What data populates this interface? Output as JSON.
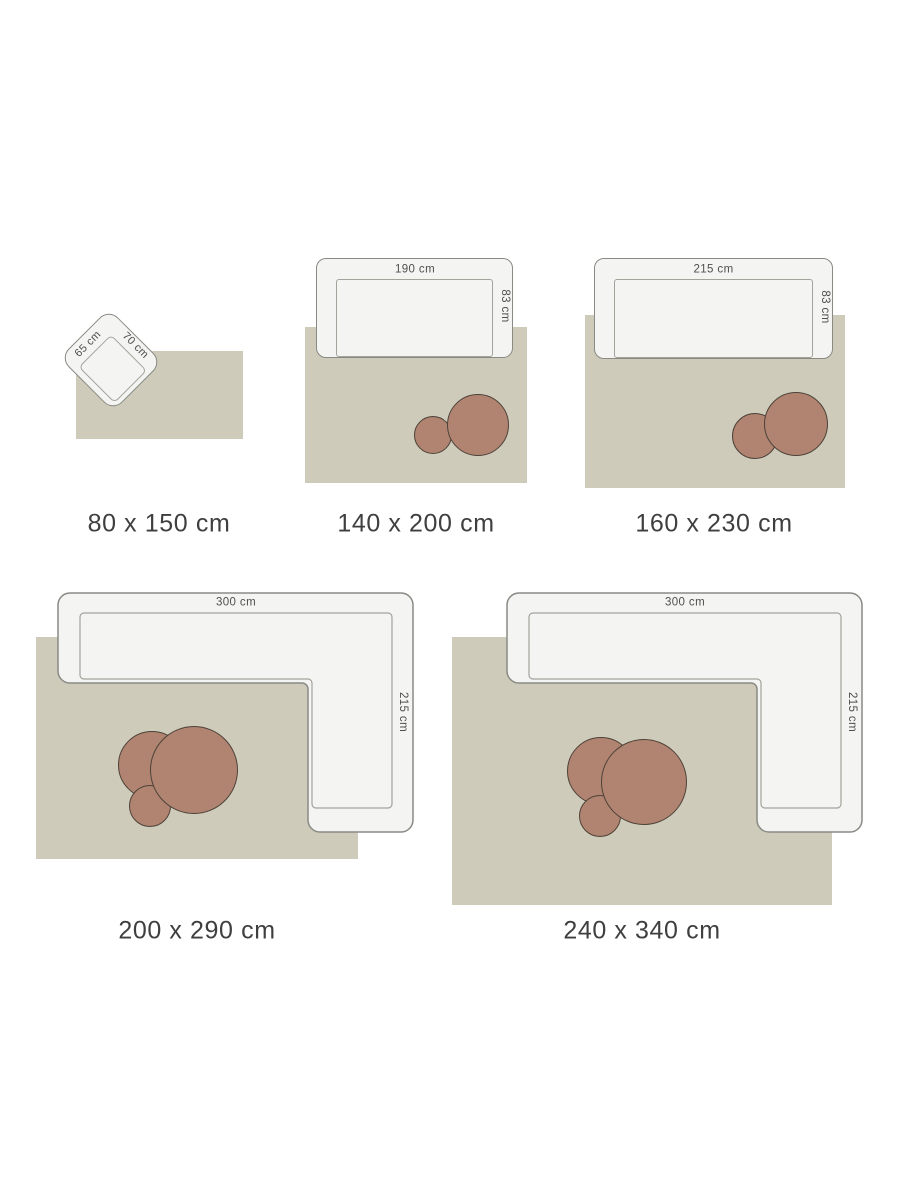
{
  "page": {
    "background": "#ffffff"
  },
  "palette": {
    "rug_fill": "#cecbba",
    "furniture_fill": "#f4f4f2",
    "furniture_outline": "#8a8a85",
    "seat_outline": "#a3a39c",
    "table_fill": "#b08470",
    "table_outline": "#4d4239",
    "dimension_text": "#4f4f4f",
    "size_label_text": "#3f3f3f"
  },
  "items": [
    {
      "size_label": "80 x 150 cm",
      "furniture": {
        "type": "armchair",
        "width_label": "65 cm",
        "depth_label": "70 cm"
      },
      "tables": 0
    },
    {
      "size_label": "140 x 200 cm",
      "furniture": {
        "type": "sofa",
        "width_label": "190 cm",
        "depth_label": "83 cm"
      },
      "tables": 2
    },
    {
      "size_label": "160 x 230 cm",
      "furniture": {
        "type": "sofa",
        "width_label": "215 cm",
        "depth_label": "83 cm"
      },
      "tables": 2
    },
    {
      "size_label": "200 x 290 cm",
      "furniture": {
        "type": "corner-sofa",
        "width_label": "300 cm",
        "depth_label": "215 cm"
      },
      "tables": 3
    },
    {
      "size_label": "240 x 340 cm",
      "furniture": {
        "type": "corner-sofa",
        "width_label": "300 cm",
        "depth_label": "215 cm"
      },
      "tables": 3
    }
  ]
}
